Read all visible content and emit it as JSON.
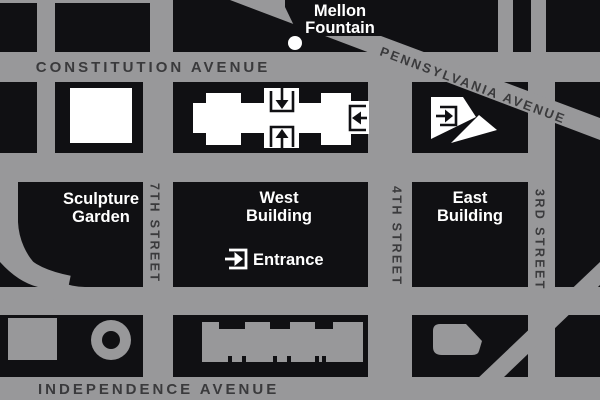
{
  "map": {
    "colors": {
      "road_gray": "#98989a",
      "block_black": "#101013",
      "label_dark": "#3a3a3c",
      "label_light": "#ffffff",
      "footprint_white": "#ffffff"
    },
    "avenues": {
      "constitution": "CONSTITUTION AVENUE",
      "pennsylvania": "PENNSYLVANIA AVENUE",
      "independence": "INDEPENDENCE AVENUE"
    },
    "streets": {
      "seventh": "7TH STREET",
      "fourth": "4TH STREET",
      "third": "3RD STREET"
    },
    "labels": {
      "mellon_fountain": {
        "line1": "Mellon",
        "line2": "Fountain"
      },
      "sculpture_garden": {
        "line1": "Sculpture",
        "line2": "Garden"
      },
      "west_building": {
        "line1": "West",
        "line2": "Building"
      },
      "east_building": {
        "line1": "East",
        "line2": "Building"
      },
      "entrance": "Entrance"
    },
    "entrances": [
      {
        "building": "West Building",
        "side": "north",
        "symbol": "arrow-down-into-box"
      },
      {
        "building": "West Building",
        "side": "south",
        "symbol": "arrow-up-into-box"
      },
      {
        "building": "West Building",
        "side": "east",
        "symbol": "arrow-left-into-box"
      },
      {
        "building": "East Building",
        "side": "west",
        "symbol": "arrow-right-into-box"
      },
      {
        "building": "West Building",
        "side": "south-label",
        "symbol": "arrow-right-into-box"
      }
    ],
    "points_of_interest": [
      "Mellon Fountain",
      "Sculpture Garden",
      "West Building",
      "East Building"
    ]
  }
}
